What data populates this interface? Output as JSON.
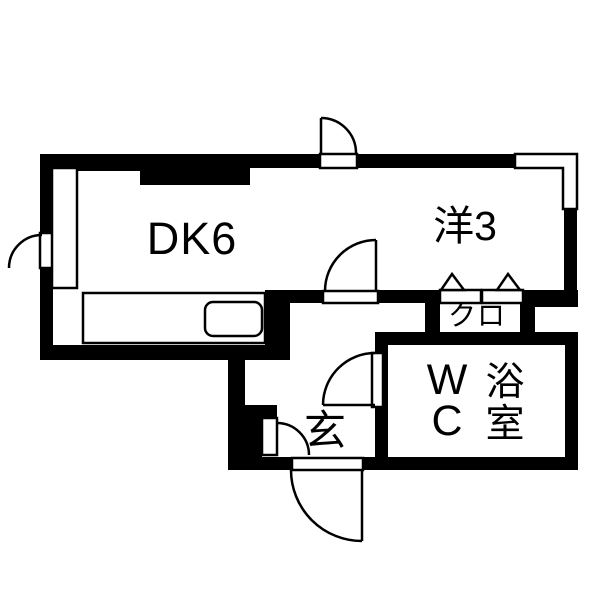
{
  "plan": {
    "type": "apartment-floorplan",
    "labels": {
      "dining_kitchen": "DK6",
      "western_room": "洋3",
      "closet": "クロ",
      "entrance": "玄",
      "wc_line1": "W",
      "wc_line2": "C",
      "bath_line1": "浴",
      "bath_line2": "室"
    },
    "colors": {
      "wall": "#000000",
      "background": "#ffffff",
      "line": "#000000",
      "fixture_fill": "#ffffff"
    }
  }
}
